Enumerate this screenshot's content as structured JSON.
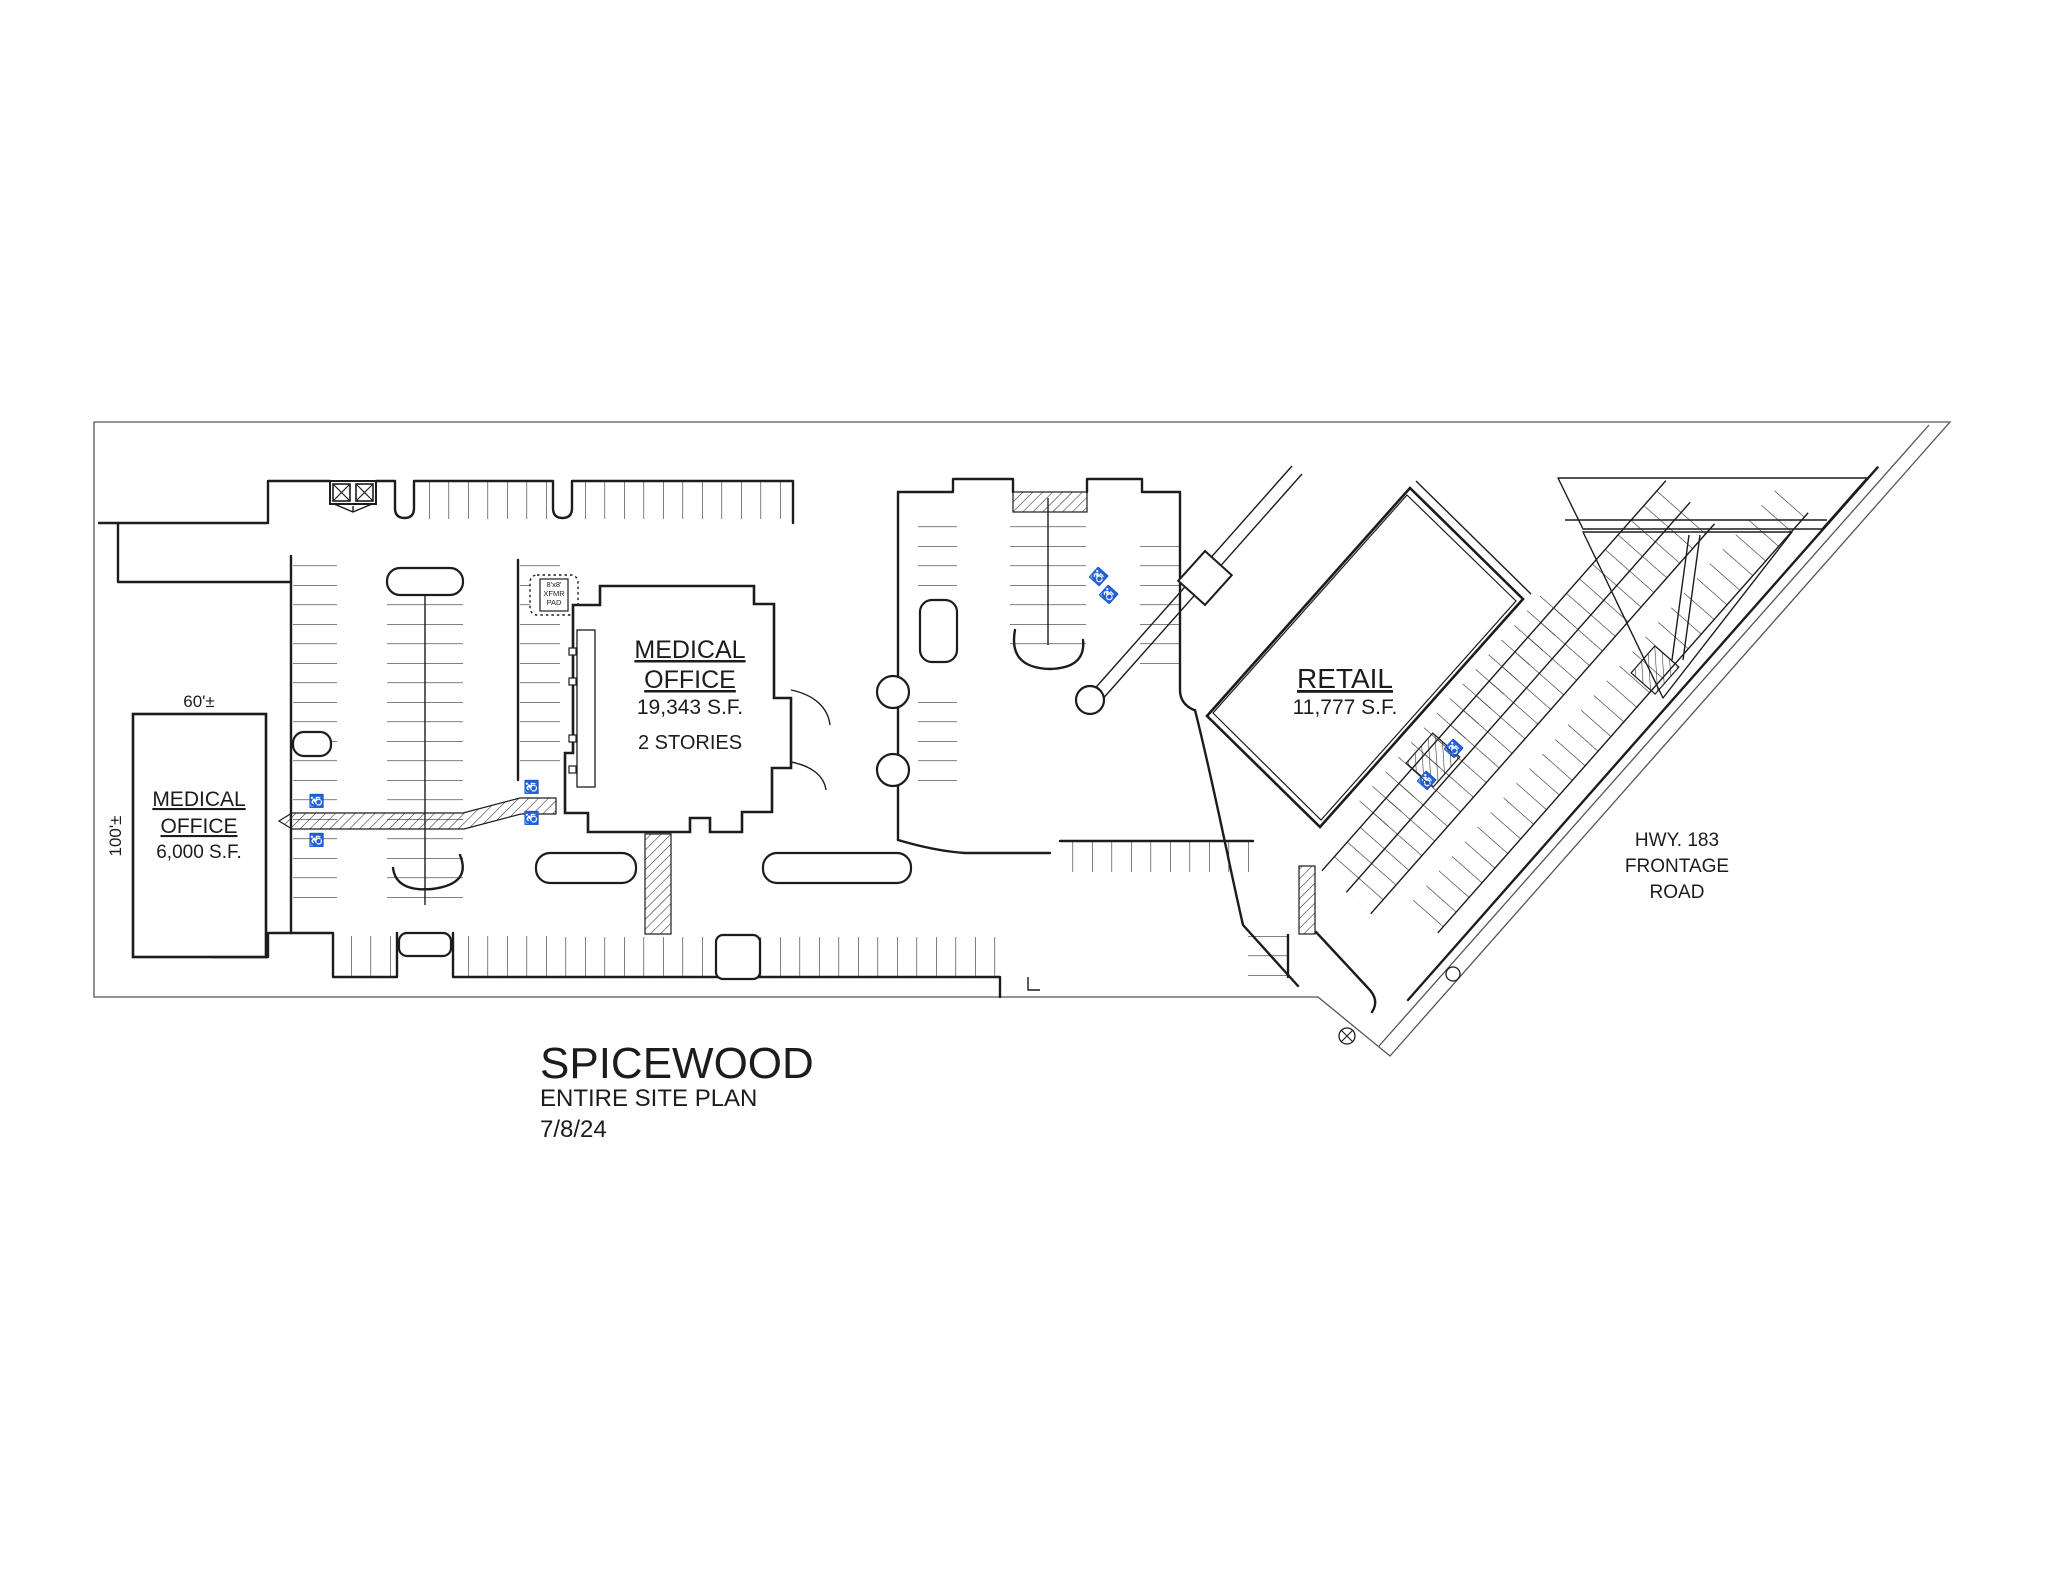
{
  "drawing": {
    "title": "SPICEWOOD",
    "subtitle": "ENTIRE SITE PLAN",
    "date": "7/8/24"
  },
  "buildings": {
    "west": {
      "line1": "MEDICAL",
      "line2": "OFFICE",
      "area": "6,000 S.F.",
      "width_dim": "60'±",
      "depth_dim": "100'±"
    },
    "central": {
      "line1": "MEDICAL",
      "line2": "OFFICE",
      "area": "19,343 S.F.",
      "stories": "2 STORIES"
    },
    "retail": {
      "line1": "RETAIL",
      "area": "11,777 S.F."
    }
  },
  "road": {
    "line1": "HWY. 183",
    "line2": "FRONTAGE",
    "line3": "ROAD"
  },
  "features": {
    "xfmr_pad_line1": "8'x8'",
    "xfmr_pad_line2": "XFMR",
    "xfmr_pad_line3": "PAD",
    "accessible_symbol": "♿"
  },
  "colors": {
    "ink": "#1c1c1c",
    "boundary": "#555555",
    "paper": "#ffffff"
  }
}
